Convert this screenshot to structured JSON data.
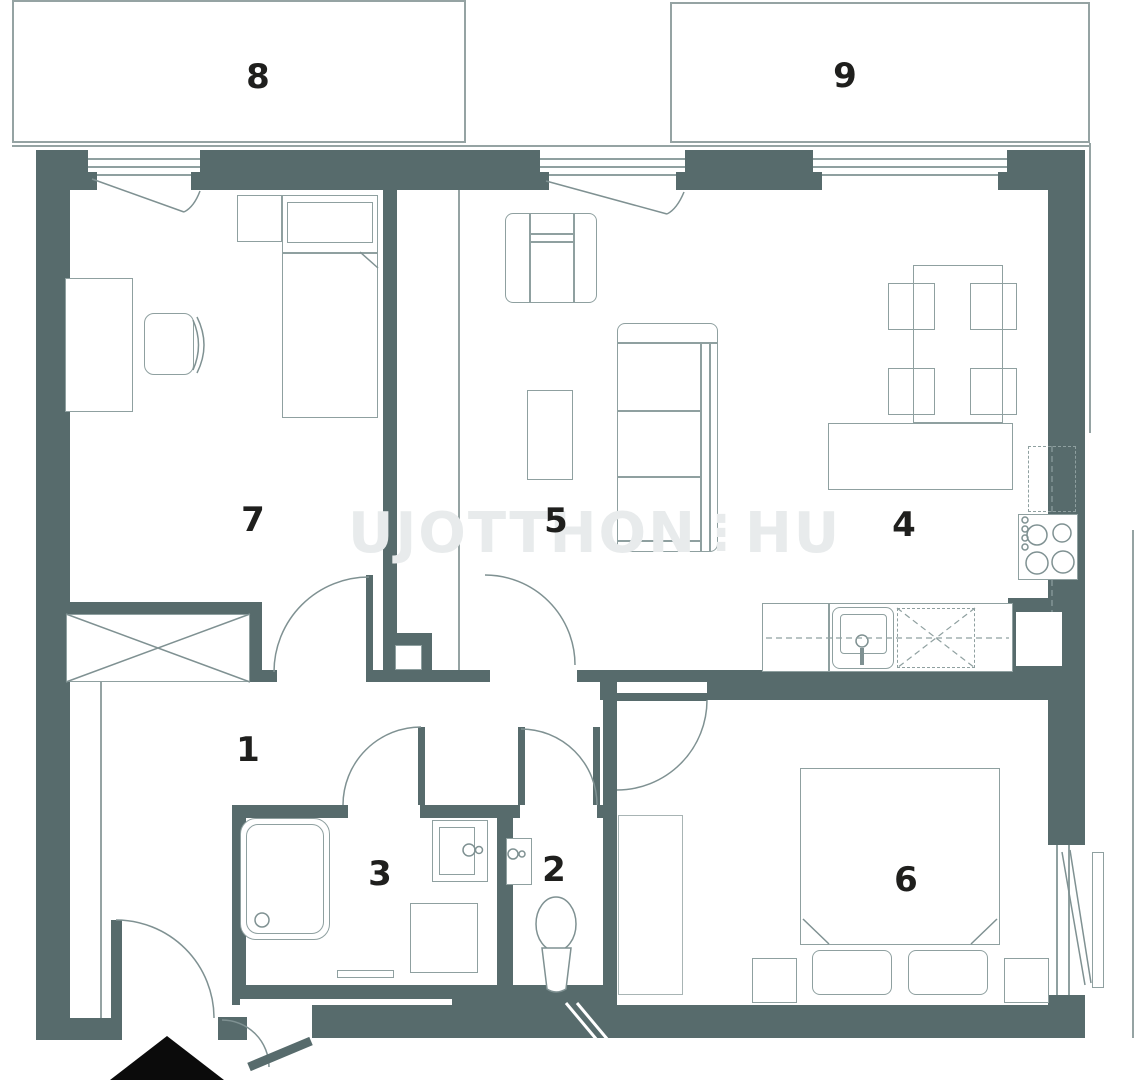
{
  "colors": {
    "wall": "#576b6c",
    "furniture_line": "#8fa0a0",
    "structure_line": "#95a3a3",
    "label_text": "#1f1f1d",
    "watermark_text": "#e8ebec",
    "entrance_arrow": "#0b0b0b",
    "background": "#ffffff"
  },
  "watermark": {
    "part1": "UJOTTHON",
    "separator": "⋮",
    "part2": "HU"
  },
  "rooms": [
    {
      "label": "1"
    },
    {
      "label": "2"
    },
    {
      "label": "3"
    },
    {
      "label": "4"
    },
    {
      "label": "5"
    },
    {
      "label": "6"
    },
    {
      "label": "7"
    },
    {
      "label": "8"
    },
    {
      "label": "9"
    }
  ]
}
